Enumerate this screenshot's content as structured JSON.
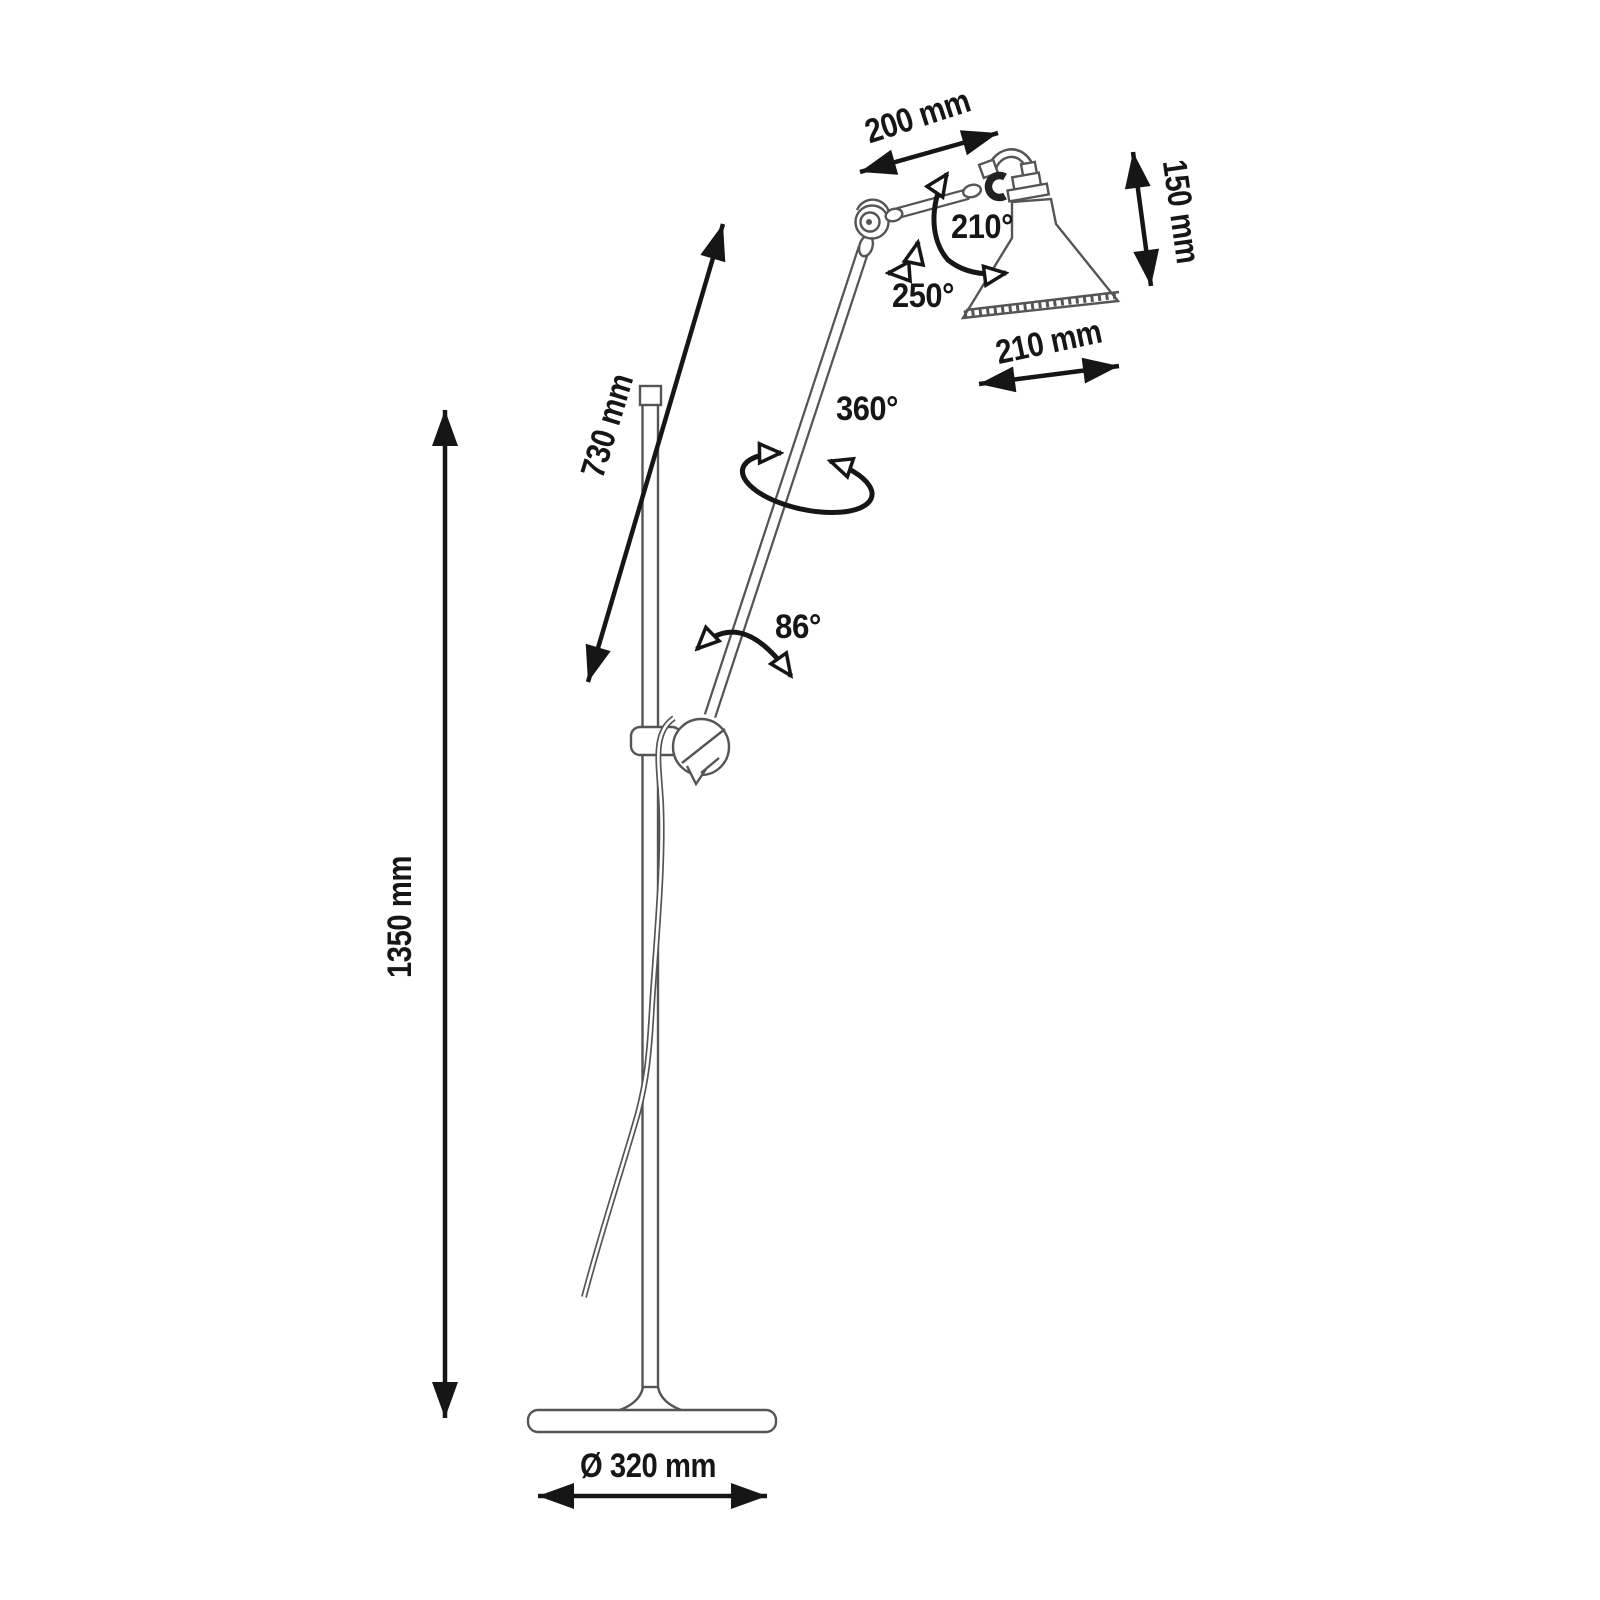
{
  "diagram": {
    "type": "technical-dimension-drawing",
    "subject": "articulated floor lamp with conical shade",
    "background_color": "#ffffff",
    "lamp_line_color": "#555555",
    "dimension_color": "#161616",
    "labels": {
      "upper_arm_length": "200 mm",
      "head_height": "150 mm",
      "shade_width": "210 mm",
      "shade_rotation": "210°",
      "elbow_rotation": "250°",
      "arm_axis_rotation": "360°",
      "lower_arm_length": "730 mm",
      "lower_joint_angle": "86°",
      "total_height": "1350 mm",
      "base_diameter": "Ø 320 mm"
    }
  }
}
